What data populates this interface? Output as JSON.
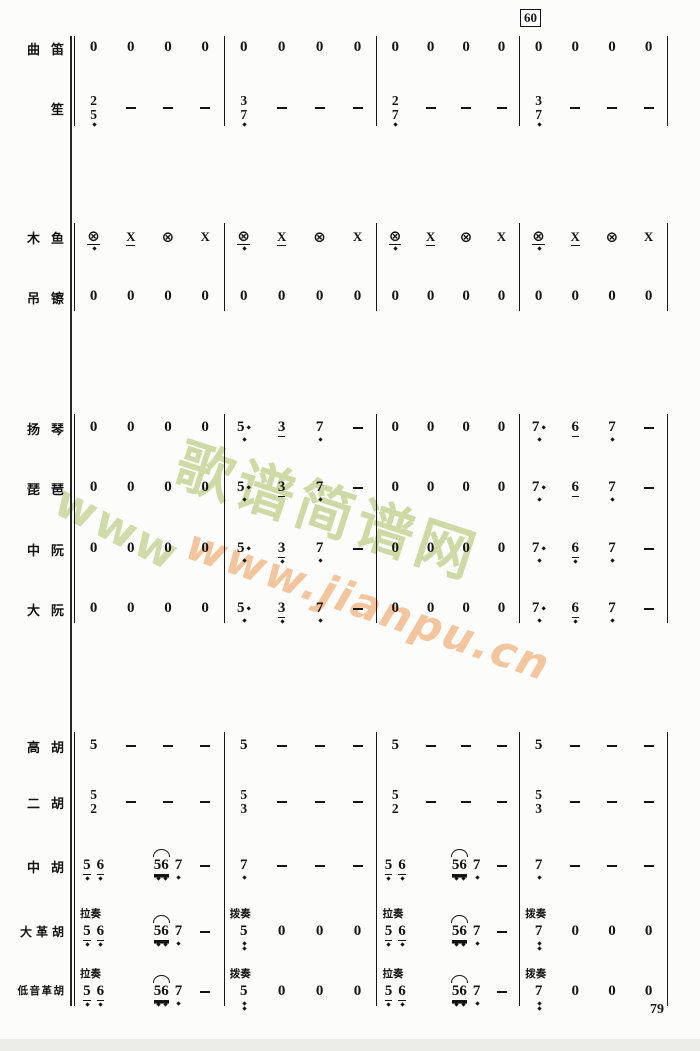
{
  "meta": {
    "measure_number": "60",
    "page_number": "79"
  },
  "watermark": {
    "brand": "歌谱简谱网",
    "www": "www",
    "url": "www.jianpu.cn",
    "green_color": "#cdd8a2",
    "orange_color": "#f2c39a"
  },
  "ink_color": "#141414",
  "groups": [
    {
      "top": 36,
      "bottom": 126
    },
    {
      "top": 223,
      "bottom": 311
    },
    {
      "top": 414,
      "bottom": 623
    },
    {
      "top": 732,
      "bottom": 1006
    }
  ],
  "instruments": [
    {
      "name": "曲笛",
      "group": 0,
      "y": 48,
      "measures": [
        [
          "0",
          "0",
          "0",
          "0"
        ],
        [
          "0",
          "0",
          "0",
          "0"
        ],
        [
          "0",
          "0",
          "0",
          "0"
        ],
        [
          "0",
          "0",
          "0",
          "0"
        ]
      ]
    },
    {
      "name": "笙",
      "group": 0,
      "y": 108,
      "stack": true,
      "measures": [
        [
          "2/5,",
          "-",
          "-",
          "-"
        ],
        [
          "3/7,",
          "-",
          "-",
          "-"
        ],
        [
          "2/7,",
          "-",
          "-",
          "-"
        ],
        [
          "3/7,",
          "-",
          "-",
          "-"
        ]
      ]
    },
    {
      "name": "木鱼",
      "group": 1,
      "y": 237,
      "measures": [
        [
          "⊗',",
          "x'",
          "⊗",
          "x"
        ],
        [
          "⊗',",
          "x'",
          "⊗",
          "x"
        ],
        [
          "⊗',",
          "x'",
          "⊗",
          "x"
        ],
        [
          "⊗',",
          "x'",
          "⊗",
          "x"
        ]
      ]
    },
    {
      "name": "吊镲",
      "group": 1,
      "y": 297,
      "measures": [
        [
          "0",
          "0",
          "0",
          "0"
        ],
        [
          "0",
          "0",
          "0",
          "0"
        ],
        [
          "0",
          "0",
          "0",
          "0"
        ],
        [
          "0",
          "0",
          "0",
          "0"
        ]
      ]
    },
    {
      "name": "扬琴",
      "group": 2,
      "y": 428,
      "measures": [
        [
          "0",
          "0",
          "0",
          "0"
        ],
        [
          "5.,",
          "3'",
          "7,",
          "-"
        ],
        [
          "0",
          "0",
          "0",
          "0"
        ],
        [
          "7.,",
          "6'",
          "7,",
          "-"
        ]
      ]
    },
    {
      "name": "琵琶",
      "group": 2,
      "y": 488,
      "measures": [
        [
          "0",
          "0",
          "0",
          "0"
        ],
        [
          "5.,",
          "3'",
          "7,",
          "-"
        ],
        [
          "0",
          "0",
          "0",
          "0"
        ],
        [
          "7.,",
          "6'",
          "7,",
          "-"
        ]
      ]
    },
    {
      "name": "中阮",
      "group": 2,
      "y": 549,
      "measures": [
        [
          "0",
          "0",
          "0",
          "0"
        ],
        [
          "5.,",
          "3',",
          "7,",
          "-"
        ],
        [
          "0",
          "0",
          "0",
          "0"
        ],
        [
          "7.,",
          "6',",
          "7,",
          "-"
        ]
      ]
    },
    {
      "name": "大阮",
      "group": 2,
      "y": 609,
      "measures": [
        [
          "0",
          "0",
          "0",
          "0"
        ],
        [
          "5.,",
          "3',",
          "7,",
          "-"
        ],
        [
          "0",
          "0",
          "0",
          "0"
        ],
        [
          "7.,",
          "6',",
          "7,",
          "-"
        ]
      ]
    },
    {
      "name": "高胡",
      "group": 3,
      "y": 746,
      "measures": [
        [
          "5",
          "-",
          "-",
          "-"
        ],
        [
          "5",
          "-",
          "-",
          "-"
        ],
        [
          "5",
          "-",
          "-",
          "-"
        ],
        [
          "5",
          "-",
          "-",
          "-"
        ]
      ]
    },
    {
      "name": "二胡",
      "group": 3,
      "y": 802,
      "stack": true,
      "measures": [
        [
          "5/2",
          "-",
          "-",
          "-"
        ],
        [
          "5/3",
          "-",
          "-",
          "-"
        ],
        [
          "5/2",
          "-",
          "-",
          "-"
        ],
        [
          "5/3",
          "-",
          "-",
          "-"
        ]
      ]
    },
    {
      "name": "中胡",
      "group": 3,
      "y": 866,
      "measures": [
        [
          "5', 6',",
          "",
          "~56'', 7,",
          "-"
        ],
        [
          "7,",
          "-",
          "-",
          "-"
        ],
        [
          "5', 6',",
          "",
          "~56'', 7,",
          "-"
        ],
        [
          "7,",
          "-",
          "-",
          "-"
        ]
      ]
    },
    {
      "name": "大革胡",
      "group": 3,
      "y": 932,
      "tech": [
        "拉奏",
        "拨奏",
        "拉奏",
        "拨奏"
      ],
      "measures": [
        [
          "5', 6',",
          "",
          "~56'', 7,",
          "-"
        ],
        [
          "5,,",
          "0",
          "0",
          "0"
        ],
        [
          "5', 6',",
          "",
          "~56'', 7,",
          "-"
        ],
        [
          "7,,",
          "0",
          "0",
          "0"
        ]
      ]
    },
    {
      "name": "低音革胡",
      "group": 3,
      "y": 992,
      "tech": [
        "拉奏",
        "拨奏",
        "拉奏",
        "拨奏"
      ],
      "measures": [
        [
          "5', 6',",
          "",
          "~56'', 7,",
          "-"
        ],
        [
          "5,,",
          "0",
          "0",
          "0"
        ],
        [
          "5', 6',",
          "",
          "~56'', 7,",
          "-"
        ],
        [
          "7,,",
          "0",
          "0",
          "0"
        ]
      ]
    }
  ]
}
